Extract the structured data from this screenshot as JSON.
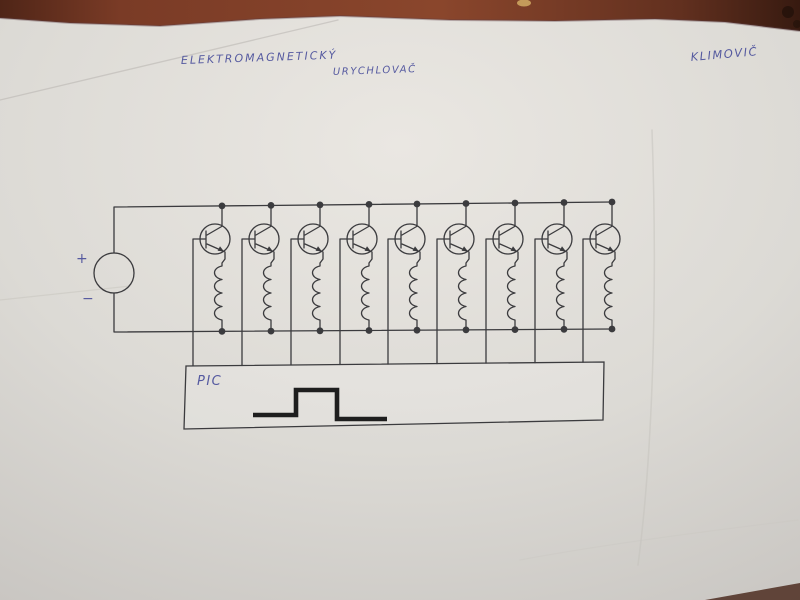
{
  "annotations": {
    "title_line1": "ELEKTROMAGNETICKÝ",
    "title_line2": "URYCHLOVAČ",
    "author": "KLIMOVIČ"
  },
  "circuit": {
    "type": "hand-drawn schematic: electromagnetic accelerator coil driver",
    "power_supply": {
      "plus_label": "+",
      "minus_label": "−"
    },
    "controller_label": "PIC",
    "stage_count": 9,
    "stage_xs": [
      222,
      271,
      320,
      369,
      417,
      466,
      515,
      564,
      612
    ],
    "waveform": {
      "type": "pulse",
      "points": [
        [
          253,
          415
        ],
        [
          296,
          415
        ],
        [
          296,
          390
        ],
        [
          337,
          390
        ],
        [
          337,
          419
        ],
        [
          387,
          419
        ]
      ]
    }
  },
  "colors": {
    "ink": "#3b3b3e",
    "handwriting_blue": "#4a4f9b",
    "pulse": "#1e1e1e",
    "paper": "#dcdad5",
    "table": "#7a3b26"
  }
}
